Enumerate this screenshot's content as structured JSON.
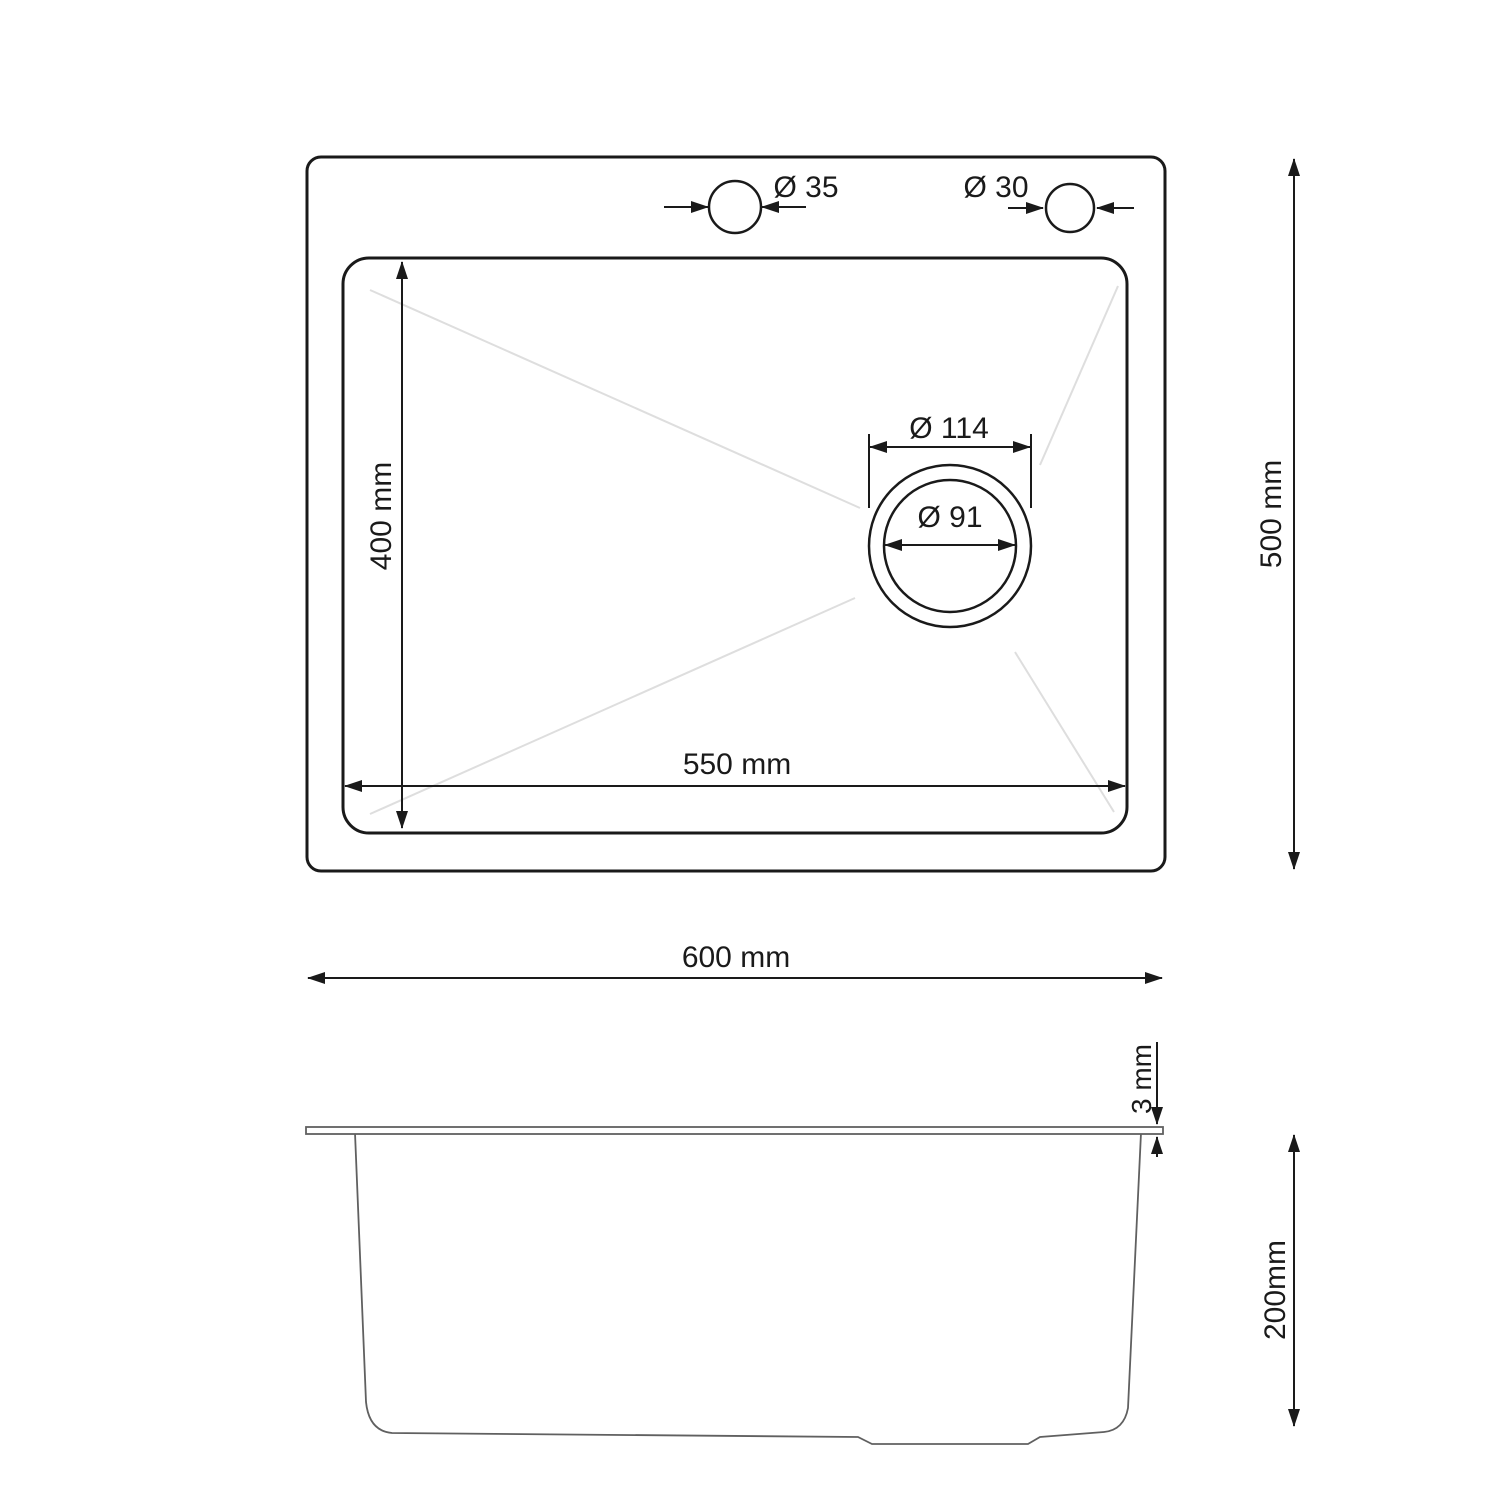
{
  "colors": {
    "outline": "#1a1a1a",
    "side_outline": "#606060",
    "slope_line": "#dedede",
    "background": "#ffffff"
  },
  "top_view": {
    "faucet_hole_left": {
      "label": "Ø 35"
    },
    "faucet_hole_right": {
      "label": "Ø 30"
    },
    "drain_outer": {
      "label": "Ø 114"
    },
    "drain_inner": {
      "label": "Ø 91"
    },
    "bowl_width": {
      "label": "550 mm"
    },
    "bowl_depth": {
      "label": "400 mm"
    },
    "overall_width": {
      "label": "600 mm"
    },
    "overall_depth": {
      "label": "500 mm"
    }
  },
  "side_view": {
    "rim_thickness": {
      "label": "3 mm"
    },
    "body_height": {
      "label": "200mm"
    }
  }
}
